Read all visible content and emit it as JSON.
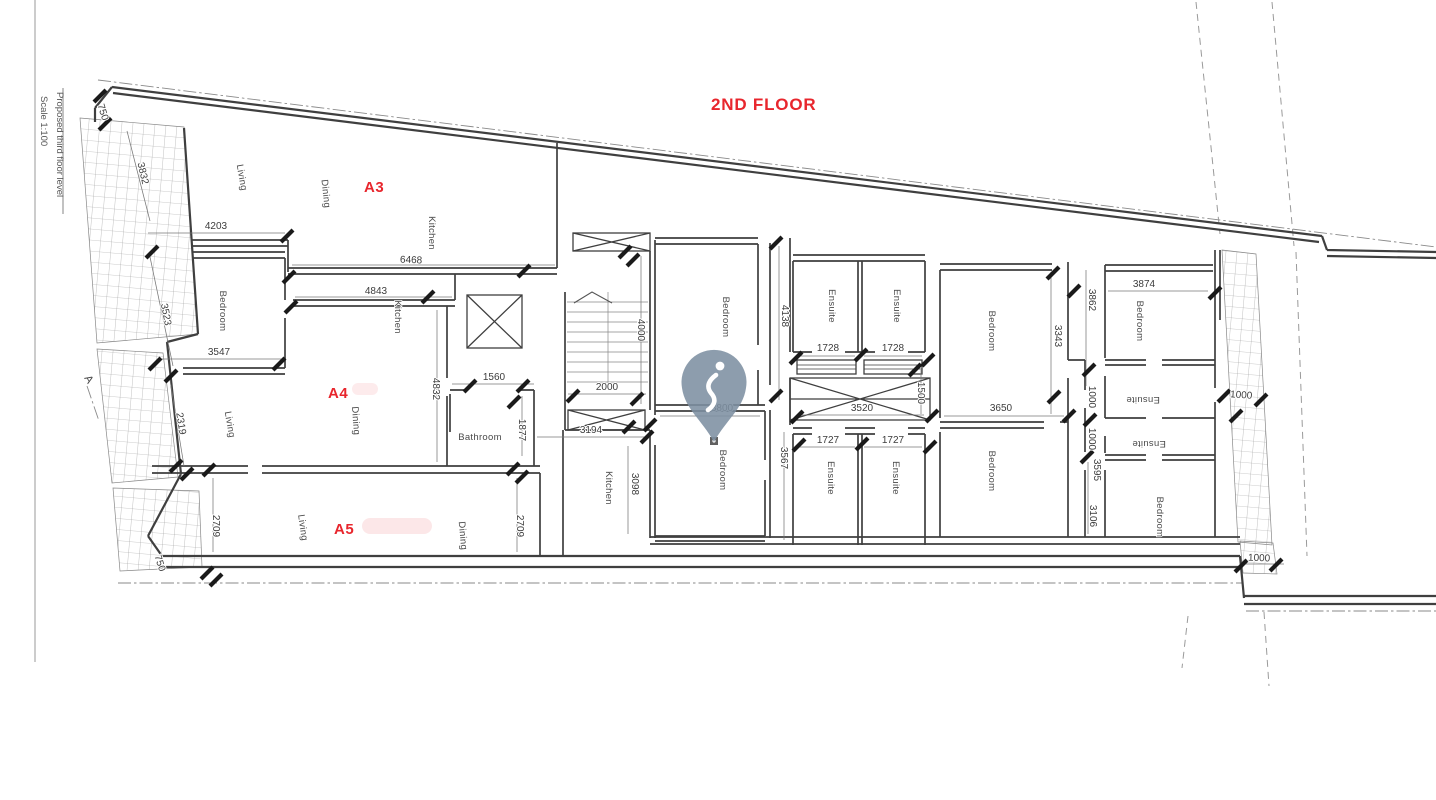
{
  "colors": {
    "accent": "#e8262d",
    "pin": "#7d8fa2",
    "wall": "#3f3f3f"
  },
  "title": "2ND FLOOR",
  "sheet": {
    "margin_note": "Proposed third floor level",
    "scale_note": "Scale 1:100",
    "section_marker": "A"
  },
  "units": {
    "a3": "A3",
    "a4": "A4",
    "a5": "A5"
  },
  "rooms": {
    "a3_living": "Living",
    "a3_dining": "Dining",
    "a3_kitchen": "Kitchen",
    "a4_bedroom": "Bedroom",
    "a4_kitchen": "Kitchen",
    "a4_living": "Living",
    "a4_dining": "Dining",
    "a4_bathroom": "Bathroom",
    "a5_living": "Living",
    "a5_dining": "Dining",
    "mid_kitchen": "Kitchen",
    "center_bedroom_top": "Bedroom",
    "center_bedroom_bottom": "Bedroom",
    "ensuite_top_left": "Ensuite",
    "ensuite_top_right": "Ensuite",
    "ensuite_bottom_left": "Ensuite",
    "ensuite_bottom_right": "Ensuite",
    "right_bedroom_top": "Bedroom",
    "right_bedroom_bottom": "Bedroom",
    "far_bedroom_top": "Bedroom",
    "far_ensuite_top": "Ensuite",
    "far_ensuite_bottom": "Ensuite",
    "far_bedroom_bottom": "Bedroom"
  },
  "dims": {
    "d750_top": "750",
    "d3832": "3832",
    "d4203": "4203",
    "d6468": "6468",
    "d4843": "4843",
    "d3523": "3523",
    "d3547": "3547",
    "d2319": "2319",
    "d2709_left": "2709",
    "d2709_right": "2709",
    "d750_bottom": "750",
    "d4832": "4832",
    "d1560": "1560",
    "d1877": "1877",
    "d3194": "3194",
    "d2000": "2000",
    "d4000": "4000",
    "d3098": "3098",
    "d3800": "3800",
    "d4138": "4138",
    "d1728_left": "1728",
    "d1728_right": "1728",
    "d1727_left": "1727",
    "d1727_right": "1727",
    "d3567": "3567",
    "d3520": "3520",
    "d1500": "1500",
    "d3343": "3343",
    "d3650": "3650",
    "d3862": "3862",
    "d3595": "3595",
    "d1000_corridor_upper": "1000",
    "d1000_corridor_lower": "1000",
    "d3874": "3874",
    "d1000_terrace_upper": "1000",
    "d3106": "3106",
    "d1000_terrace_lower": "1000"
  }
}
